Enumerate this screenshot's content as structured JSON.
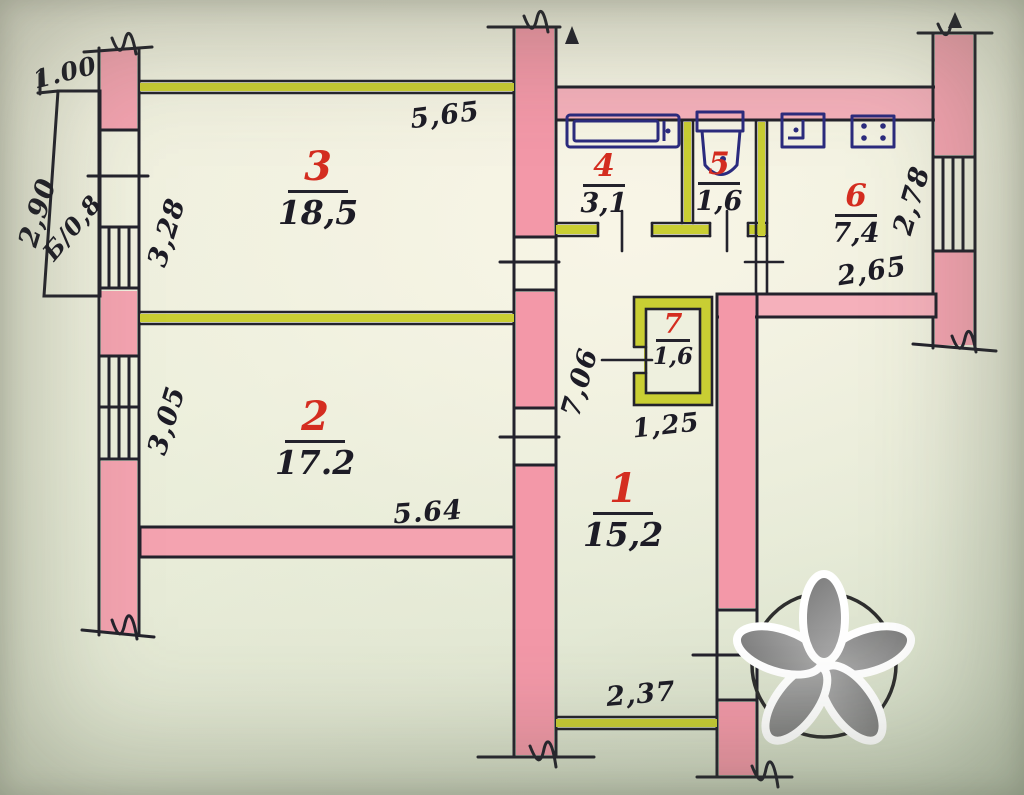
{
  "plan": {
    "rooms": [
      {
        "number": "3",
        "area": "18,5"
      },
      {
        "number": "2",
        "area": "17.2"
      },
      {
        "number": "1",
        "area": "15,2"
      },
      {
        "number": "4",
        "area": "3,1"
      },
      {
        "number": "5",
        "area": "1,6"
      },
      {
        "number": "6",
        "area": "7,4"
      },
      {
        "number": "7",
        "area": "1,6"
      }
    ],
    "balcony": {
      "label": "Б/0,8"
    },
    "dims": {
      "balcony_width": "1.00",
      "balcony_length": "2,90",
      "room3_width": "3,28",
      "room3_length": "5,65",
      "room2_width": "3,05",
      "room2_length": "5.64",
      "hall_length": "7,06",
      "kitchen_height": "2,78",
      "kitchen_width": "2,65",
      "closet_width": "1,25",
      "hall_width": "2,37"
    },
    "colors": {
      "paper": "#ebeedd",
      "wall_fill": "#f4a3b0",
      "partition": "#c9ce33",
      "ink": "#1d1c26",
      "room_number_red": "#d42d20",
      "fixture_blue": "#2b2b7e"
    }
  }
}
